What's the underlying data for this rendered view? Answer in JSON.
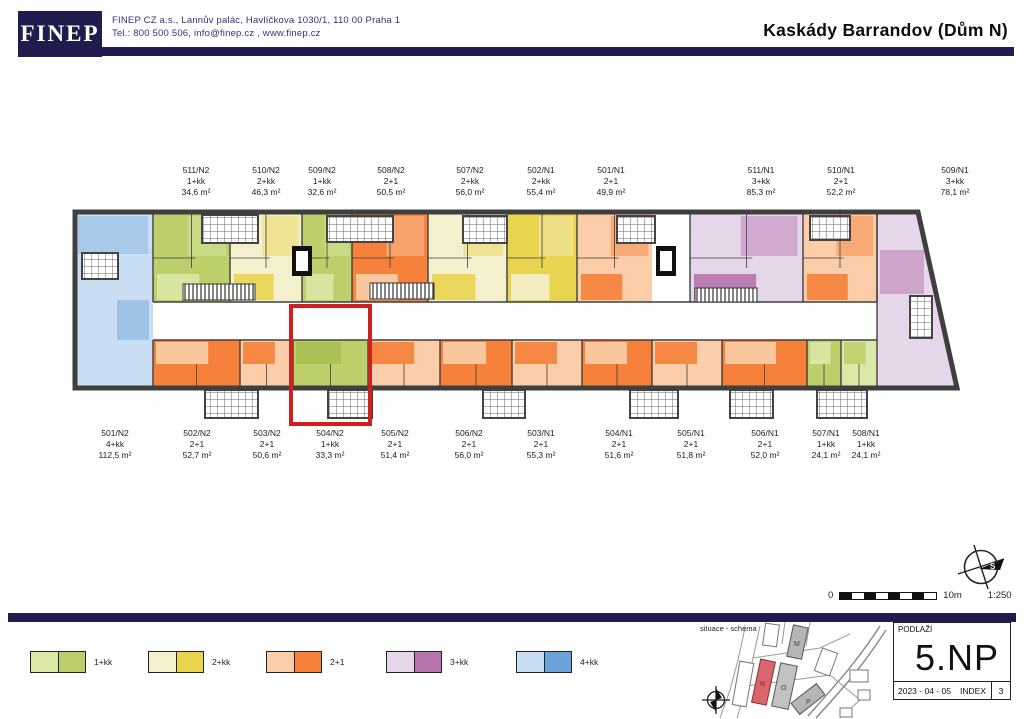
{
  "header": {
    "logo": "FINEP",
    "address_line1": "FINEP CZ a.s., Lannův palác, Havlíčkova 1030/1, 110 00 Praha 1",
    "address_line2": "Tel.: 800 500 506,  info@finep.cz , www.finep.cz",
    "title": "Kaskády Barrandov (Dům N)"
  },
  "palette": {
    "navy": "#201d4e",
    "wall": "#3f3f3f",
    "highlight_red": "#cf2020",
    "green_light": "#dce8a8",
    "green": "#bccf6a",
    "green_dark": "#a9bf52",
    "cream": "#f4efcd",
    "yellow": "#e9d44f",
    "peach": "#fbcda8",
    "orange": "#f5813a",
    "purple_light": "#e5d6e9",
    "purple": "#b574ae",
    "blue_light": "#c9ddf3",
    "blue": "#6aa3d8"
  },
  "floorplan": {
    "highlight_unit": "504/N2",
    "units_top": [
      {
        "id": "511/N2",
        "type": "1+kk",
        "area": "34,6 m²",
        "label_x": 196,
        "x1": 153,
        "x2": 230,
        "fill": "green",
        "core": "green_light"
      },
      {
        "id": "510/N2",
        "type": "2+kk",
        "area": "46,3 m²",
        "label_x": 266,
        "x1": 230,
        "x2": 302,
        "fill": "cream",
        "core": "yellow"
      },
      {
        "id": "509/N2",
        "type": "1+kk",
        "area": "32,6 m²",
        "label_x": 322,
        "x1": 302,
        "x2": 352,
        "fill": "green",
        "core": "green_light"
      },
      {
        "id": "508/N2",
        "type": "2+1",
        "area": "50,5 m²",
        "label_x": 391,
        "x1": 352,
        "x2": 428,
        "fill": "orange",
        "core": "peach"
      },
      {
        "id": "507/N2",
        "type": "2+kk",
        "area": "56,0 m²",
        "label_x": 470,
        "x1": 428,
        "x2": 507,
        "fill": "cream",
        "core": "yellow"
      },
      {
        "id": "502/N1",
        "type": "2+kk",
        "area": "55,4 m²",
        "label_x": 541,
        "x1": 507,
        "x2": 577,
        "fill": "yellow",
        "core": "cream"
      },
      {
        "id": "501/N1",
        "type": "2+1",
        "area": "49,9 m²",
        "label_x": 611,
        "x1": 577,
        "x2": 652,
        "fill": "peach",
        "core": "orange"
      },
      {
        "id": "511/N1",
        "type": "3+kk",
        "area": "85,3 m²",
        "label_x": 761,
        "x1": 690,
        "x2": 803,
        "fill": "purple_light",
        "core": "purple"
      },
      {
        "id": "510/N1",
        "type": "2+1",
        "area": "52,2 m²",
        "label_x": 841,
        "x1": 803,
        "x2": 877,
        "fill": "peach",
        "core": "orange"
      },
      {
        "id": "509/N1",
        "type": "3+kk",
        "area": "78,1 m²",
        "label_x": 955,
        "x1": 877,
        "x2": 918,
        "fill": "purple_light",
        "core": "purple"
      }
    ],
    "units_bottom": [
      {
        "id": "501/N2",
        "type": "4+kk",
        "area": "112,5 m²",
        "label_x": 115,
        "x1": 75,
        "x2": 153,
        "fill": "blue_light",
        "core": "blue"
      },
      {
        "id": "502/N2",
        "type": "2+1",
        "area": "52,7 m²",
        "label_x": 197,
        "x1": 153,
        "x2": 240,
        "fill": "orange",
        "core": "peach"
      },
      {
        "id": "503/N2",
        "type": "2+1",
        "area": "50,6 m²",
        "label_x": 267,
        "x1": 240,
        "x2": 293,
        "fill": "peach",
        "core": "orange"
      },
      {
        "id": "504/N2",
        "type": "1+kk",
        "area": "33,3 m²",
        "label_x": 330,
        "x1": 293,
        "x2": 368,
        "fill": "green",
        "core": "green_dark"
      },
      {
        "id": "505/N2",
        "type": "2+1",
        "area": "51,4 m²",
        "label_x": 395,
        "x1": 368,
        "x2": 440,
        "fill": "peach",
        "core": "orange"
      },
      {
        "id": "506/N2",
        "type": "2+1",
        "area": "56,0 m²",
        "label_x": 469,
        "x1": 440,
        "x2": 512,
        "fill": "orange",
        "core": "peach"
      },
      {
        "id": "503/N1",
        "type": "2+1",
        "area": "55,3 m²",
        "label_x": 541,
        "x1": 512,
        "x2": 582,
        "fill": "peach",
        "core": "orange"
      },
      {
        "id": "504/N1",
        "type": "2+1",
        "area": "51,6 m²",
        "label_x": 619,
        "x1": 582,
        "x2": 652,
        "fill": "orange",
        "core": "peach"
      },
      {
        "id": "505/N1",
        "type": "2+1",
        "area": "51,8 m²",
        "label_x": 691,
        "x1": 652,
        "x2": 722,
        "fill": "peach",
        "core": "orange"
      },
      {
        "id": "506/N1",
        "type": "2+1",
        "area": "52,0 m²",
        "label_x": 765,
        "x1": 722,
        "x2": 807,
        "fill": "orange",
        "core": "peach"
      },
      {
        "id": "507/N1",
        "type": "1+kk",
        "area": "24,1 m²",
        "label_x": 826,
        "x1": 807,
        "x2": 841,
        "fill": "green",
        "core": "green_light"
      },
      {
        "id": "508/N1",
        "type": "1+kk",
        "area": "24,1 m²",
        "label_x": 866,
        "x1": 841,
        "x2": 877,
        "fill": "green_light",
        "core": "green"
      }
    ]
  },
  "legend": {
    "items": [
      {
        "label": "1+kk",
        "light": "green_light",
        "dark": "green"
      },
      {
        "label": "2+kk",
        "light": "cream",
        "dark": "yellow"
      },
      {
        "label": "2+1",
        "light": "peach",
        "dark": "orange"
      },
      {
        "label": "3+kk",
        "light": "purple_light",
        "dark": "purple"
      },
      {
        "label": "4+kk",
        "light": "blue_light",
        "dark": "blue"
      }
    ]
  },
  "scale_bar": {
    "zero": "0",
    "max": "10m",
    "ratio": "1:250"
  },
  "compass_label": "S",
  "site_map": {
    "label": "situace - schéma",
    "building_labels": [
      "M",
      "N",
      "O",
      "P"
    ]
  },
  "floor_box": {
    "title": "PODLAŽÍ",
    "floor": "5.NP",
    "date": "2023 - 04 - 05",
    "index_label": "INDEX",
    "index_value": "3"
  }
}
